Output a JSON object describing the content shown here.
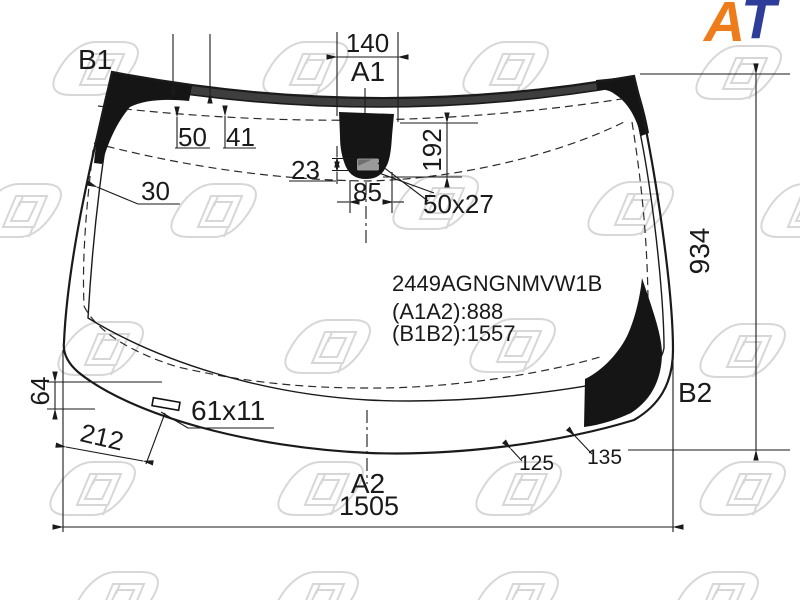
{
  "logo": {
    "letter_a": "A",
    "letter_t": "T"
  },
  "part_info": {
    "part_number": "2449AGNGNMVW1B",
    "a1a2_distance": "(A1A2):888",
    "b1b2_distance": "(B1B2):1557"
  },
  "corner_labels": {
    "b1": "B1",
    "a1": "A1",
    "a2": "A2",
    "b2": "B2"
  },
  "dimensions": {
    "d140": "140",
    "d50": "50",
    "d41": "41",
    "d30": "30",
    "d23": "23",
    "d85": "85",
    "d192": "192",
    "d50x27": "50x27",
    "d934": "934",
    "d64": "64",
    "d212": "212",
    "d61x11": "61x11",
    "d125": "125",
    "d135": "135",
    "d1505": "1505"
  },
  "colors": {
    "logo_orange": "#ee7c1b",
    "logo_blue": "#2e3d99",
    "ceramic_band": "#3e3e3e",
    "line": "#1a1a1a",
    "watermark": "#d7d7d7"
  }
}
